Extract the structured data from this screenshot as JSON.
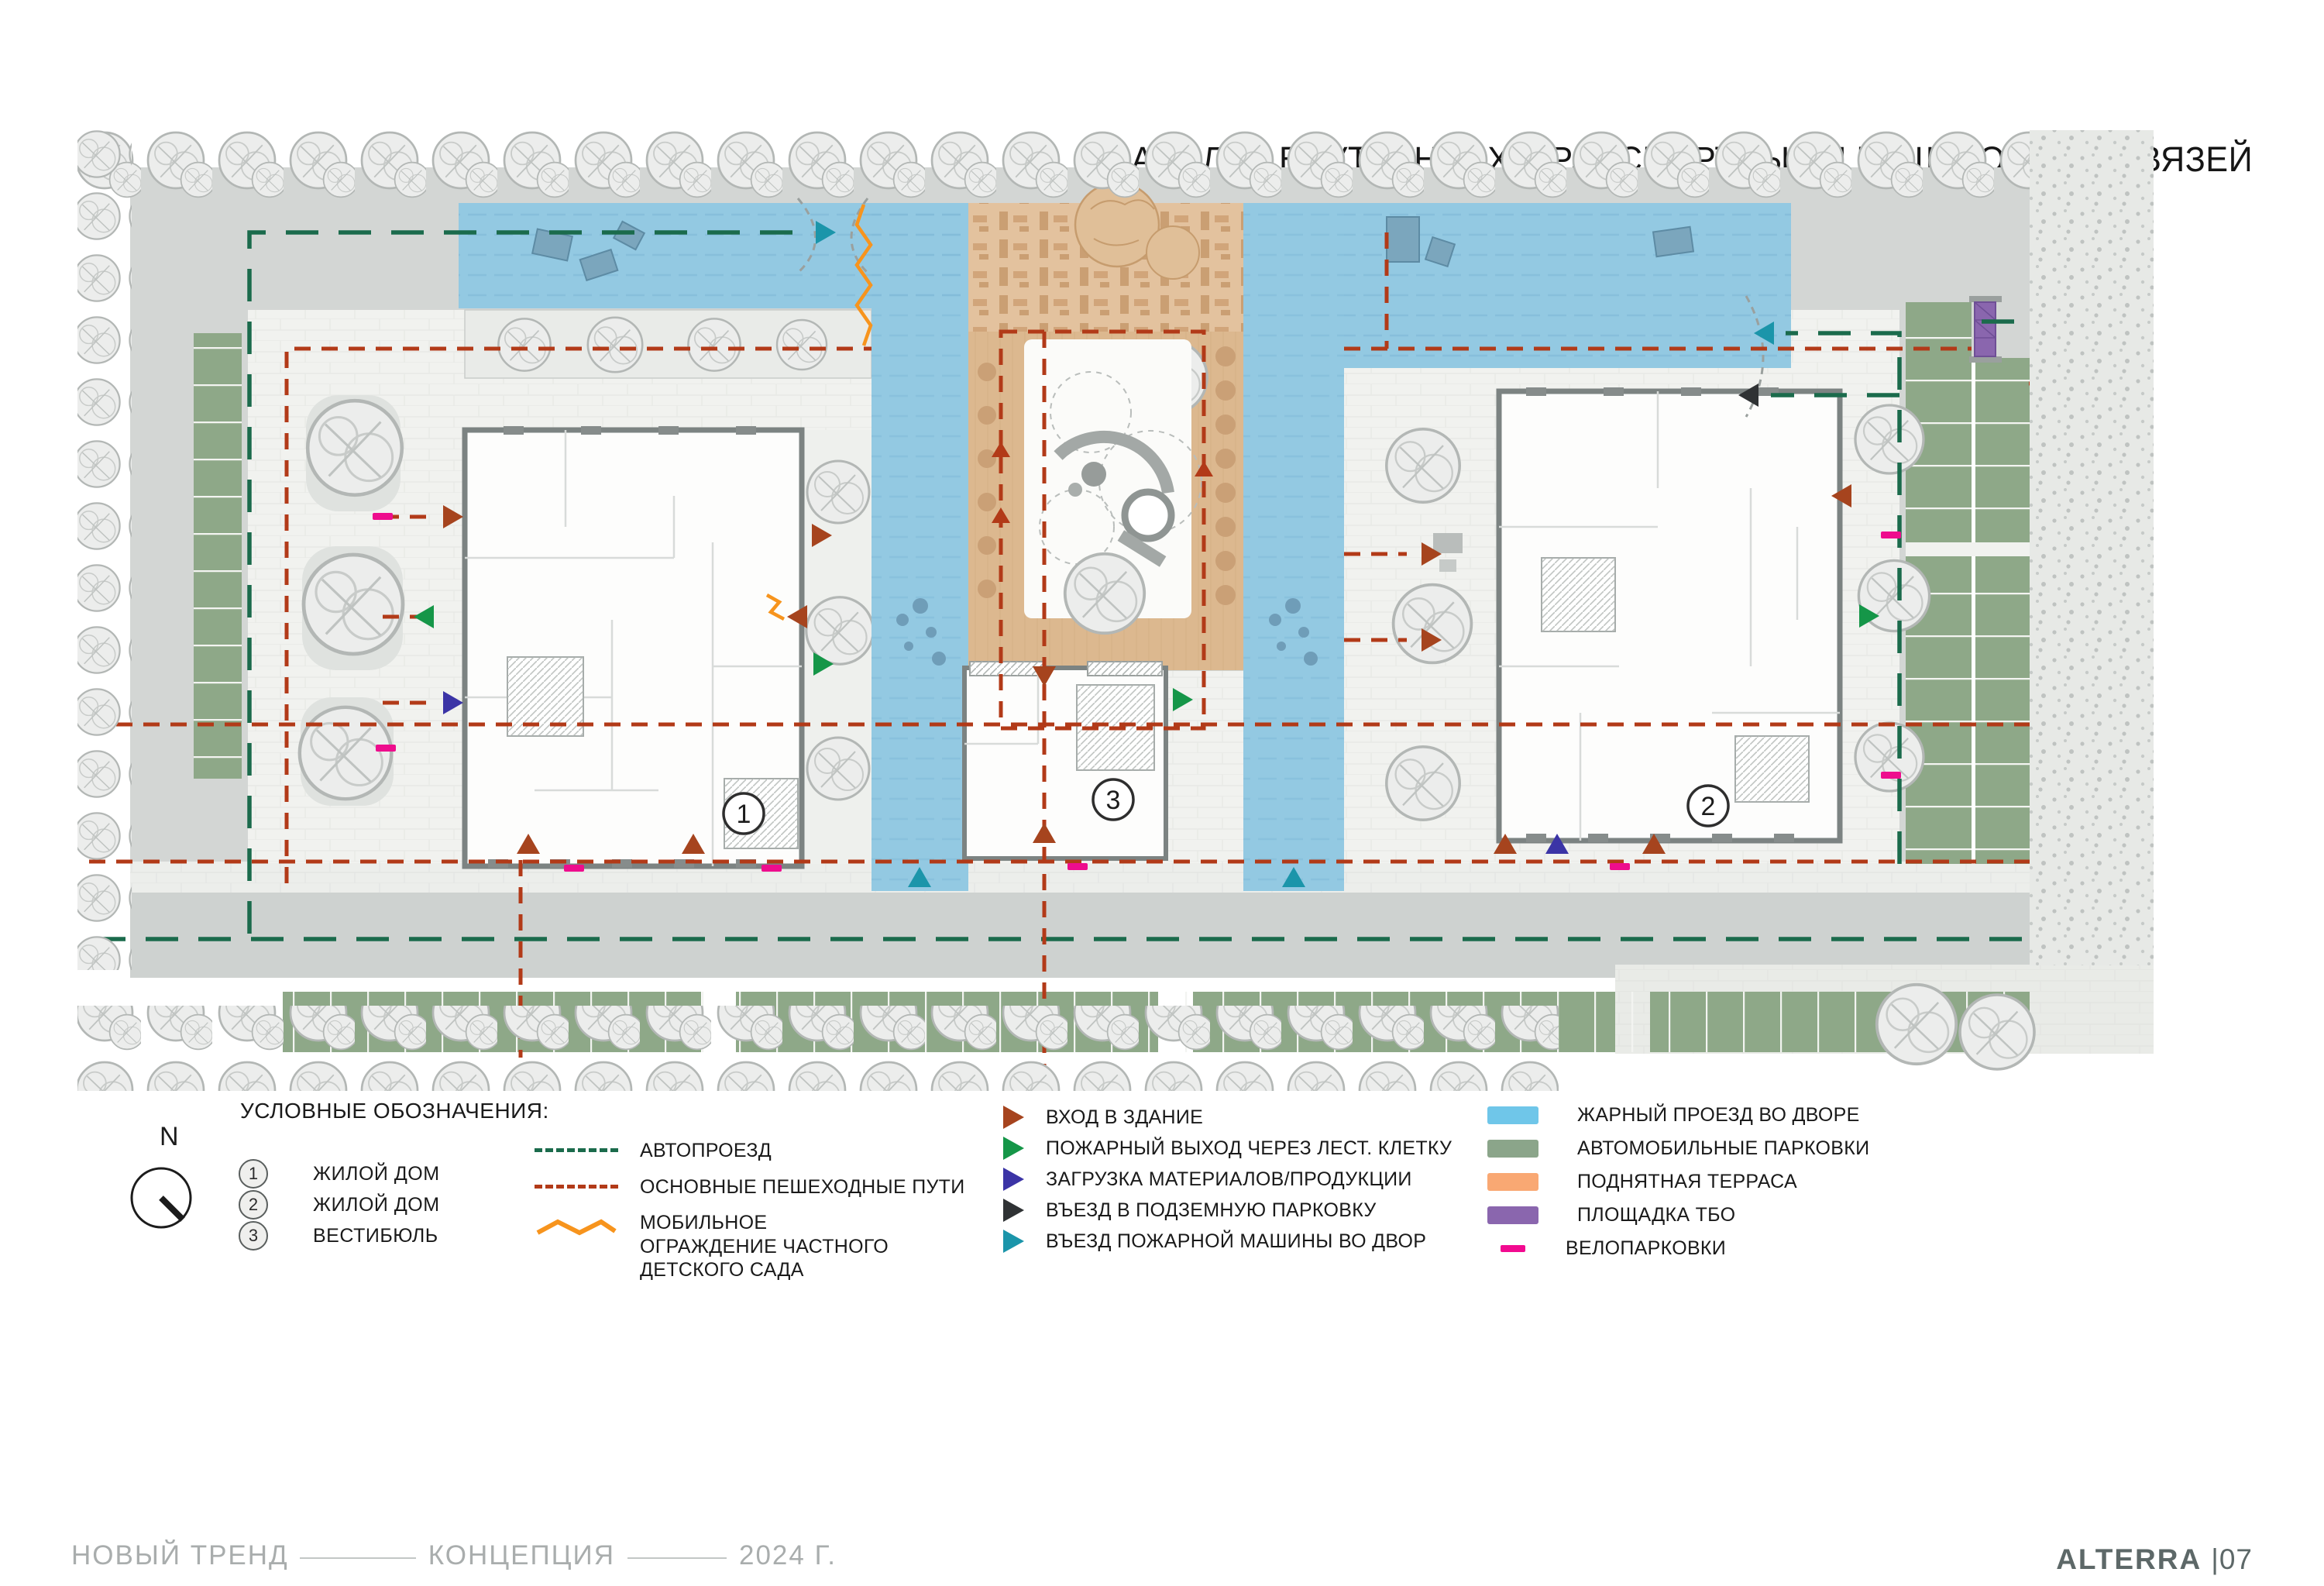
{
  "title": "АНАЛИЗ ВНУТРЕННИХ  ТРАНСПОРТНЫХ И ПЕШЕХОДНЫХ СВЯЗЕЙ",
  "plan": {
    "buildings": [
      {
        "num": "1"
      },
      {
        "num": "2"
      },
      {
        "num": "3"
      }
    ]
  },
  "legend": {
    "heading": "УСЛОВНЫЕ ОБОЗНАЧЕНИЯ:",
    "compass_label": "N",
    "numbered": [
      {
        "num": "1",
        "label": "ЖИЛОЙ ДОМ"
      },
      {
        "num": "2",
        "label": "ЖИЛОЙ ДОМ"
      },
      {
        "num": "3",
        "label": "ВЕСТИБЮЛЬ"
      }
    ],
    "lines": [
      {
        "label": "АВТОПРОЕЗД",
        "color": "#1b6b4c",
        "style": "dashed"
      },
      {
        "label": "ОСНОВНЫЕ ПЕШЕХОДНЫЕ ПУТИ",
        "color": "#b23a18",
        "style": "dashed"
      },
      {
        "label": "МОБИЛЬНОЕ ОГРАЖДЕНИЕ ЧАСТНОГО ДЕТСКОГО САДА",
        "color": "#f7941d",
        "style": "zigzag"
      }
    ],
    "arrows": [
      {
        "label": "ВХОД В ЗДАНИЕ",
        "color": "#a6441e"
      },
      {
        "label": "ПОЖАРНЫЙ ВЫХОД ЧЕРЕЗ ЛЕСТ. КЛЕТКУ",
        "color": "#159648"
      },
      {
        "label": "ЗАГРУЗКА МАТЕРИАЛОВ/ПРОДУКЦИИ",
        "color": "#3b34a6"
      },
      {
        "label": "ВЪЕЗД В ПОДЗЕМНУЮ ПАРКОВКУ",
        "color": "#2f3234"
      },
      {
        "label": "ВЪЕЗД ПОЖАРНОЙ МАШИНЫ ВО ДВОР",
        "color": "#1b95aa"
      }
    ],
    "areas": [
      {
        "label": "ЖАРНЫЙ ПРОЕЗД ВО ДВОРЕ",
        "color": "#6fc6e9"
      },
      {
        "label": "АВТОМОБИЛЬНЫЕ ПАРКОВКИ",
        "color": "#8ba58a"
      },
      {
        "label": "ПОДНЯТНАЯ ТЕРРАСА",
        "color": "#f9a873"
      },
      {
        "label": "ПЛОЩАДКА ТБО",
        "color": "#8a66ae"
      },
      {
        "label": "ВЕЛОПАРКОВКИ",
        "color": "#f20a90",
        "style": "dash"
      }
    ]
  },
  "footer": {
    "project": "НОВЫЙ ТРЕНД",
    "stage": "КОНЦЕПЦИЯ",
    "year": "2024 Г.",
    "brand": "ALTERRA",
    "page": "|07"
  }
}
